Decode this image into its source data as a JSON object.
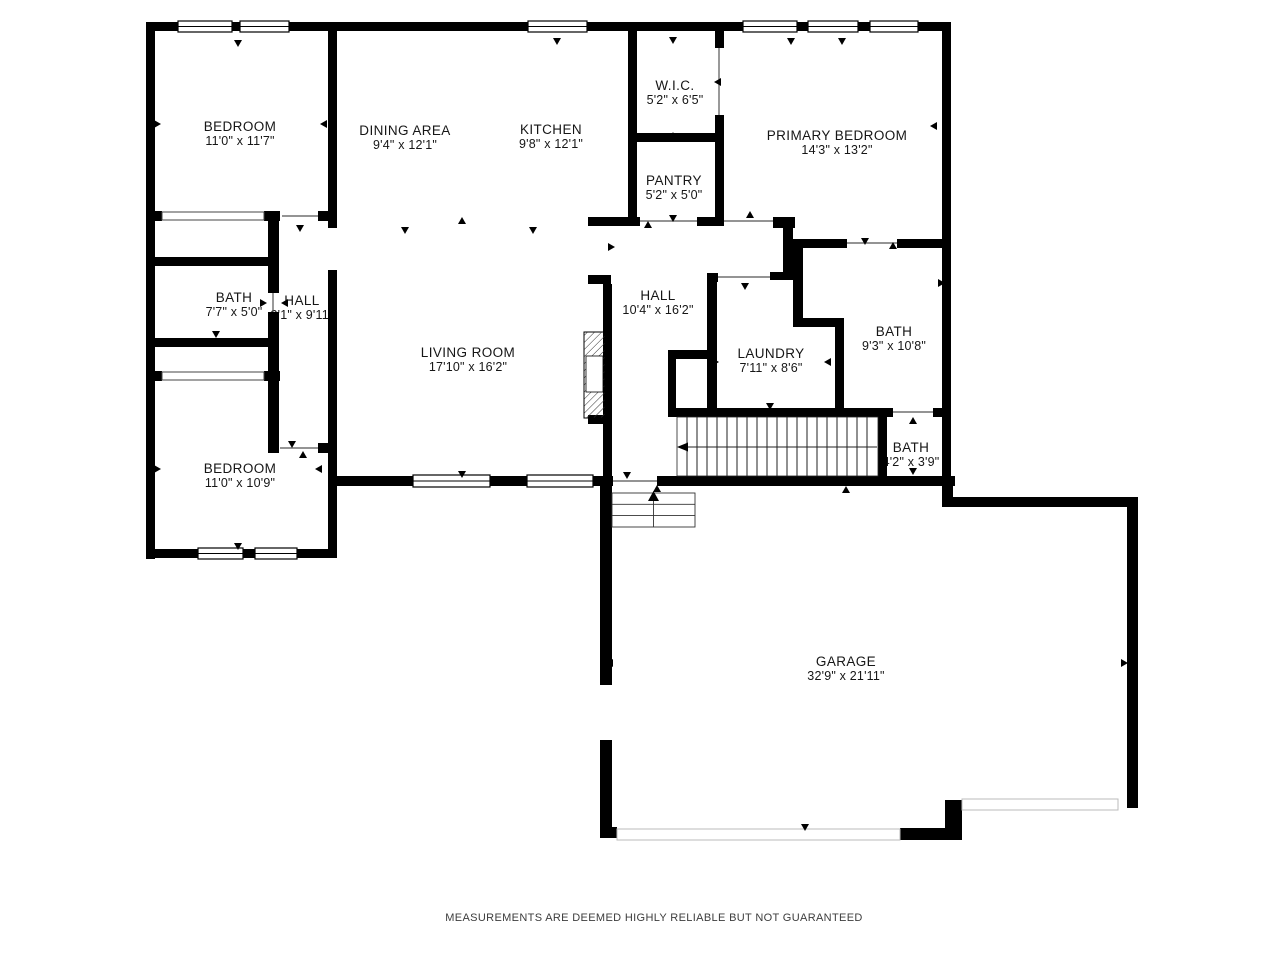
{
  "plan": {
    "type": "residential-floor-plan",
    "colors": {
      "wall": "#000000",
      "background": "#ffffff",
      "label_text": "#161616",
      "footer_text": "#3c3c3c"
    }
  },
  "rooms": [
    {
      "id": "bedroom-top",
      "name": "BEDROOM",
      "dims": "11'0\" x 11'7\""
    },
    {
      "id": "dining-area",
      "name": "DINING AREA",
      "dims": "9'4\" x 12'1\""
    },
    {
      "id": "kitchen",
      "name": "KITCHEN",
      "dims": "9'8\" x 12'1\""
    },
    {
      "id": "wic",
      "name": "W.I.C.",
      "dims": "5'2\" x 6'5\""
    },
    {
      "id": "pantry",
      "name": "PANTRY",
      "dims": "5'2\" x 5'0\""
    },
    {
      "id": "primary-bedroom",
      "name": "PRIMARY BEDROOM",
      "dims": "14'3\" x 13'2\""
    },
    {
      "id": "bath-left",
      "name": "BATH",
      "dims": "7'7\" x 5'0\""
    },
    {
      "id": "hall-left",
      "name": "HALL",
      "dims": "3'1\" x 9'11\""
    },
    {
      "id": "hall-center",
      "name": "HALL",
      "dims": "10'4\" x 16'2\""
    },
    {
      "id": "living-room",
      "name": "LIVING ROOM",
      "dims": "17'10\" x 16'2\""
    },
    {
      "id": "laundry",
      "name": "LAUNDRY",
      "dims": "7'11\" x 8'6\""
    },
    {
      "id": "bath-primary",
      "name": "BATH",
      "dims": "9'3\" x 10'8\""
    },
    {
      "id": "bath-small",
      "name": "BATH",
      "dims": "4'2\" x 3'9\""
    },
    {
      "id": "bedroom-bottom",
      "name": "BEDROOM",
      "dims": "11'0\" x 10'9\""
    },
    {
      "id": "garage",
      "name": "GARAGE",
      "dims": "32'9\" x 21'11\""
    }
  ],
  "footer": {
    "text": "MEASUREMENTS ARE DEEMED HIGHLY RELIABLE BUT NOT GUARANTEED"
  }
}
